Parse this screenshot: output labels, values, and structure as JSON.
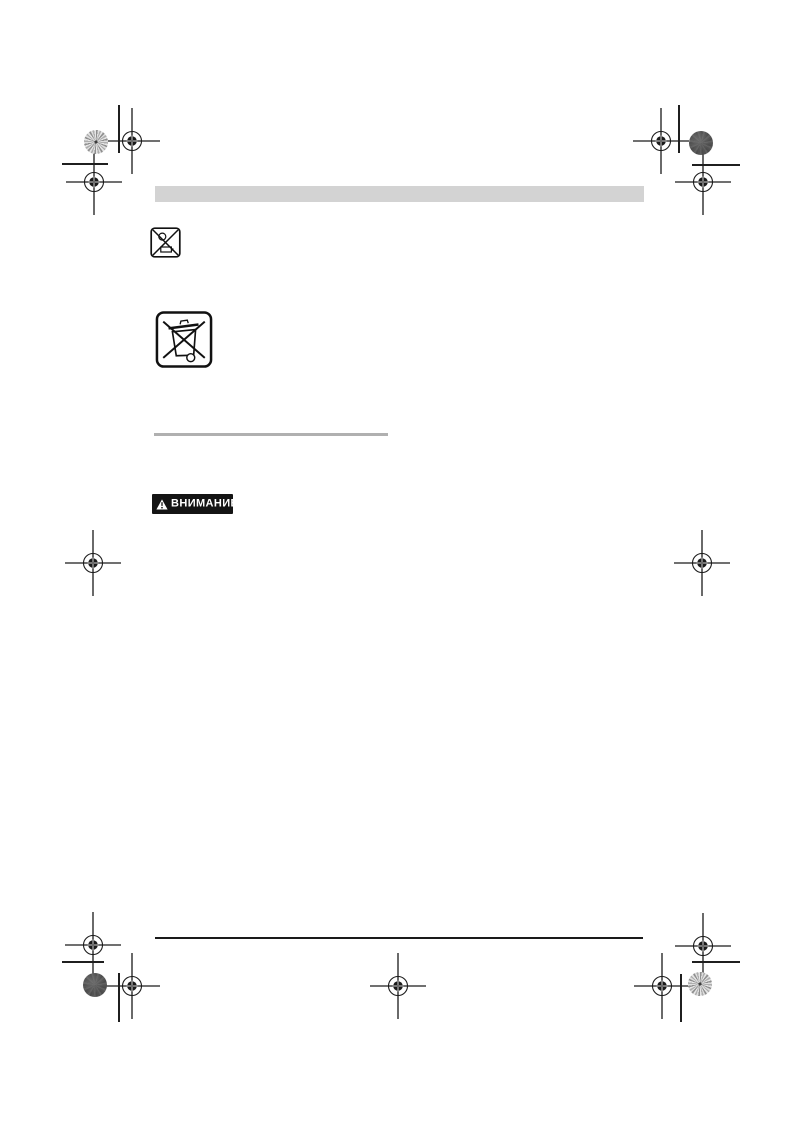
{
  "page": {
    "background": "#ffffff"
  },
  "header_bar": {
    "color": "#d3d3d3",
    "text": ""
  },
  "disposal_symbols": {
    "battery_icon": "crossed-out-battery-symbol",
    "weee_icon": "crossed-out-wheelie-bin-symbol"
  },
  "divider": {
    "color": "#b0b0b0"
  },
  "warning_badge": {
    "label": "ВНИМАНИЕ",
    "icon": "warning-triangle-icon",
    "background": "#141414",
    "text_color": "#ffffff"
  },
  "footer_rule": {
    "color": "#1a1a1a"
  },
  "print_marks": {
    "registration_mark_icon": "crosshair-registration-mark",
    "registration_mark_count": 11,
    "mark_color": "#1a1a1a",
    "color_patches": [
      {
        "position": "top-left",
        "style": "light-pinwheel-disc"
      },
      {
        "position": "top-right",
        "style": "dark-mottled-disc"
      },
      {
        "position": "bottom-left",
        "style": "dark-mottled-disc"
      },
      {
        "position": "bottom-right",
        "style": "light-pinwheel-disc"
      }
    ]
  }
}
